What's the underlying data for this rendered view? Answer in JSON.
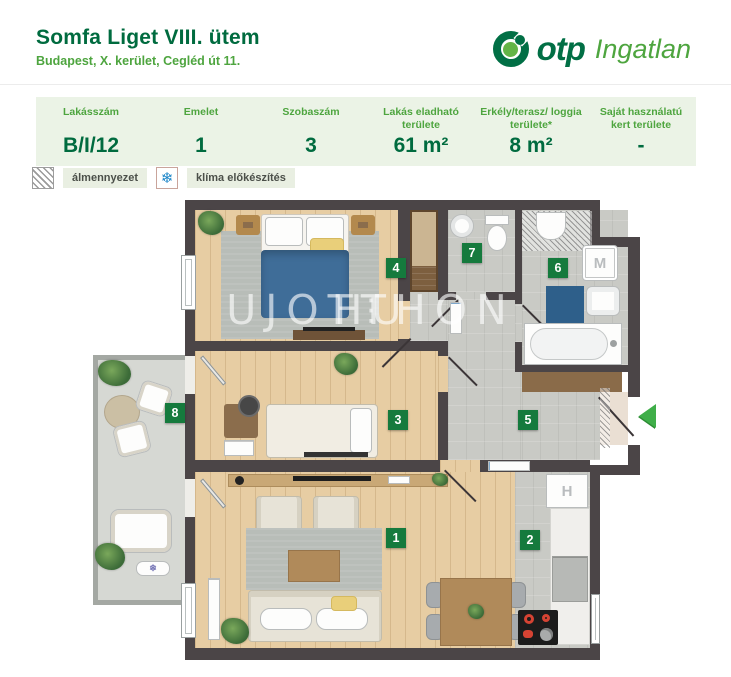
{
  "header": {
    "title": "Somfa Liget VIII. ütem",
    "subtitle": "Budapest, X. kerület, Cegléd út 11.",
    "logo": {
      "brand": "otp",
      "suffix": "Ingatlan"
    }
  },
  "table": {
    "columns": [
      {
        "label": "Lakásszám",
        "value": "B/I/12"
      },
      {
        "label": "Emelet",
        "value": "1"
      },
      {
        "label": "Szobaszám",
        "value": "3"
      },
      {
        "label": "Lakás eladható területe",
        "value": "61 m²"
      },
      {
        "label": "Erkély/terasz/ loggia területe*",
        "value": "8 m²"
      },
      {
        "label": "Saját használatú kert területe",
        "value": "-"
      }
    ]
  },
  "legend": {
    "items": [
      {
        "icon": "hatch-icon",
        "label": "álmennyezet"
      },
      {
        "icon": "snowflake-icon",
        "glyph": "❄",
        "label": "klíma előkészítés"
      }
    ]
  },
  "floorplan": {
    "rooms": [
      "1",
      "2",
      "3",
      "4",
      "5",
      "6",
      "7",
      "8"
    ],
    "appliances": {
      "washer": "M",
      "fridge": "H",
      "ac_glyph": "❄"
    },
    "watermark": {
      "left": "UJOTTHON",
      "separator": "⋮",
      "right": "HU"
    }
  },
  "colors": {
    "green_dark": "#006b3f",
    "green_mid": "#4ea53f",
    "badge": "#157a3d",
    "wall": "#4b4547",
    "wood": "#e7cda3",
    "floor_gray": "#c9cac5",
    "balcony_gray": "#d6d8d3",
    "bed_blue": "#3f6d98",
    "arrow": "#3fae49",
    "table_bg": "#ebf3e6"
  }
}
